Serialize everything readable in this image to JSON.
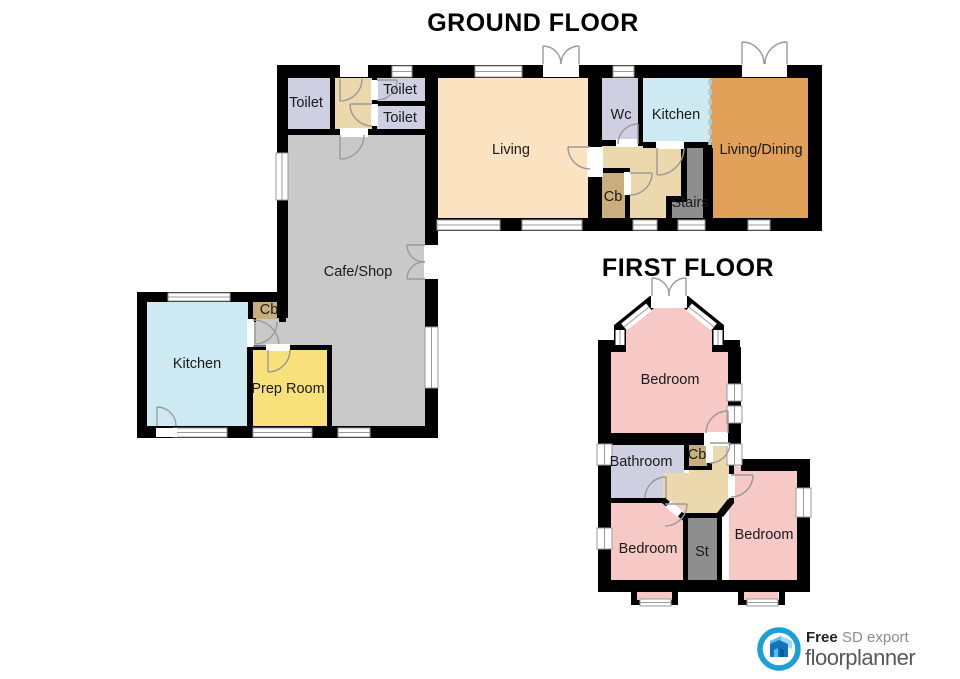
{
  "titles": {
    "ground": "GROUND FLOOR",
    "first": "FIRST FLOOR"
  },
  "rooms": {
    "ground": {
      "toilet_left": "Toilet",
      "toilet_top": "Toilet",
      "toilet_mid": "Toilet",
      "living": "Living",
      "wc": "Wc",
      "kitchen": "Kitchen",
      "living_dining": "Living/Dining",
      "cb_hall": "Cb",
      "stairs": "Stairs",
      "cafe_shop": "Cafe/Shop",
      "kitchen_annex": "Kitchen",
      "prep_room": "Prep Room",
      "cb_annex": "Cb"
    },
    "first": {
      "bedroom_top": "Bedroom",
      "bathroom": "Bathroom",
      "cb": "Cb",
      "bedroom_left": "Bedroom",
      "stairs": "St",
      "bedroom_right": "Bedroom"
    }
  },
  "logo": {
    "free": "Free",
    "sd_export": "SD export",
    "brand": "floorplanner"
  },
  "colors": {
    "wall": "#000000",
    "bedroom_pink": "#f6c9c7",
    "lavender": "#cfcfe2",
    "kitchen_cyan": "#cdeaf2",
    "living_peach": "#fbe2c1",
    "living_dining_orange": "#e2a159",
    "cafe_grey": "#c9c9c9",
    "prep_yellow": "#f8e17b",
    "closet_tan": "#c9ad7c",
    "hall_beige": "#ebd9ad",
    "stairs_grey": "#8e8e8e",
    "logo_blue": "#1b9fd8",
    "brand_grey": "#57585a"
  }
}
